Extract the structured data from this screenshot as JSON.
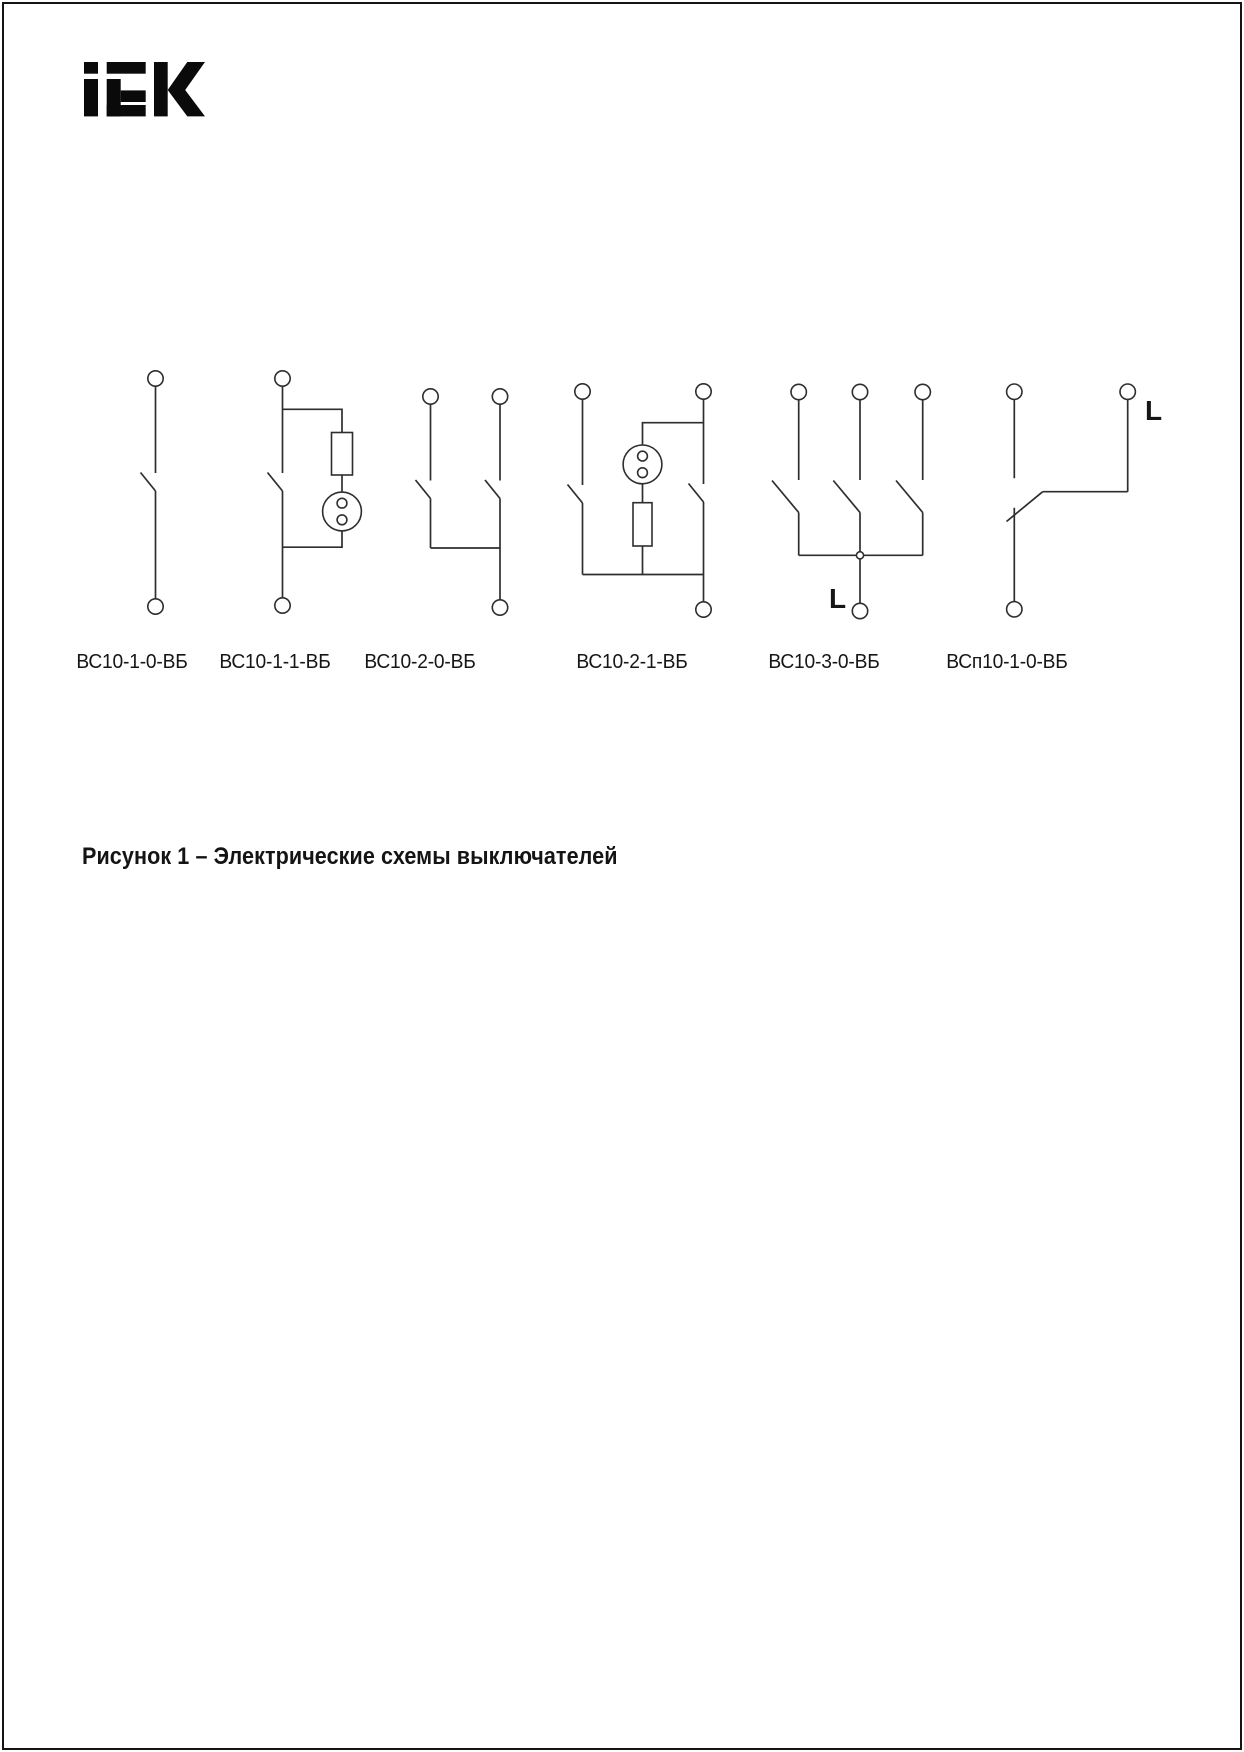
{
  "page": {
    "background": "#ffffff",
    "border_color": "#141414",
    "ink_color": "#2e2e2e"
  },
  "logo": {
    "brand": "IEK",
    "color": "#0a0a0a"
  },
  "figure": {
    "caption": "Рисунок 1 – Электрические схемы выключателей",
    "diagrams": [
      {
        "label": "ВС10-1-0-ВБ"
      },
      {
        "label": "ВС10-1-1-ВБ"
      },
      {
        "label": "ВС10-2-0-ВБ"
      },
      {
        "label": "ВС10-2-1-ВБ"
      },
      {
        "label": "ВС10-3-0-ВБ",
        "line_label": "L"
      },
      {
        "label": "ВСп10-1-0-ВБ",
        "line_label": "L"
      }
    ]
  }
}
